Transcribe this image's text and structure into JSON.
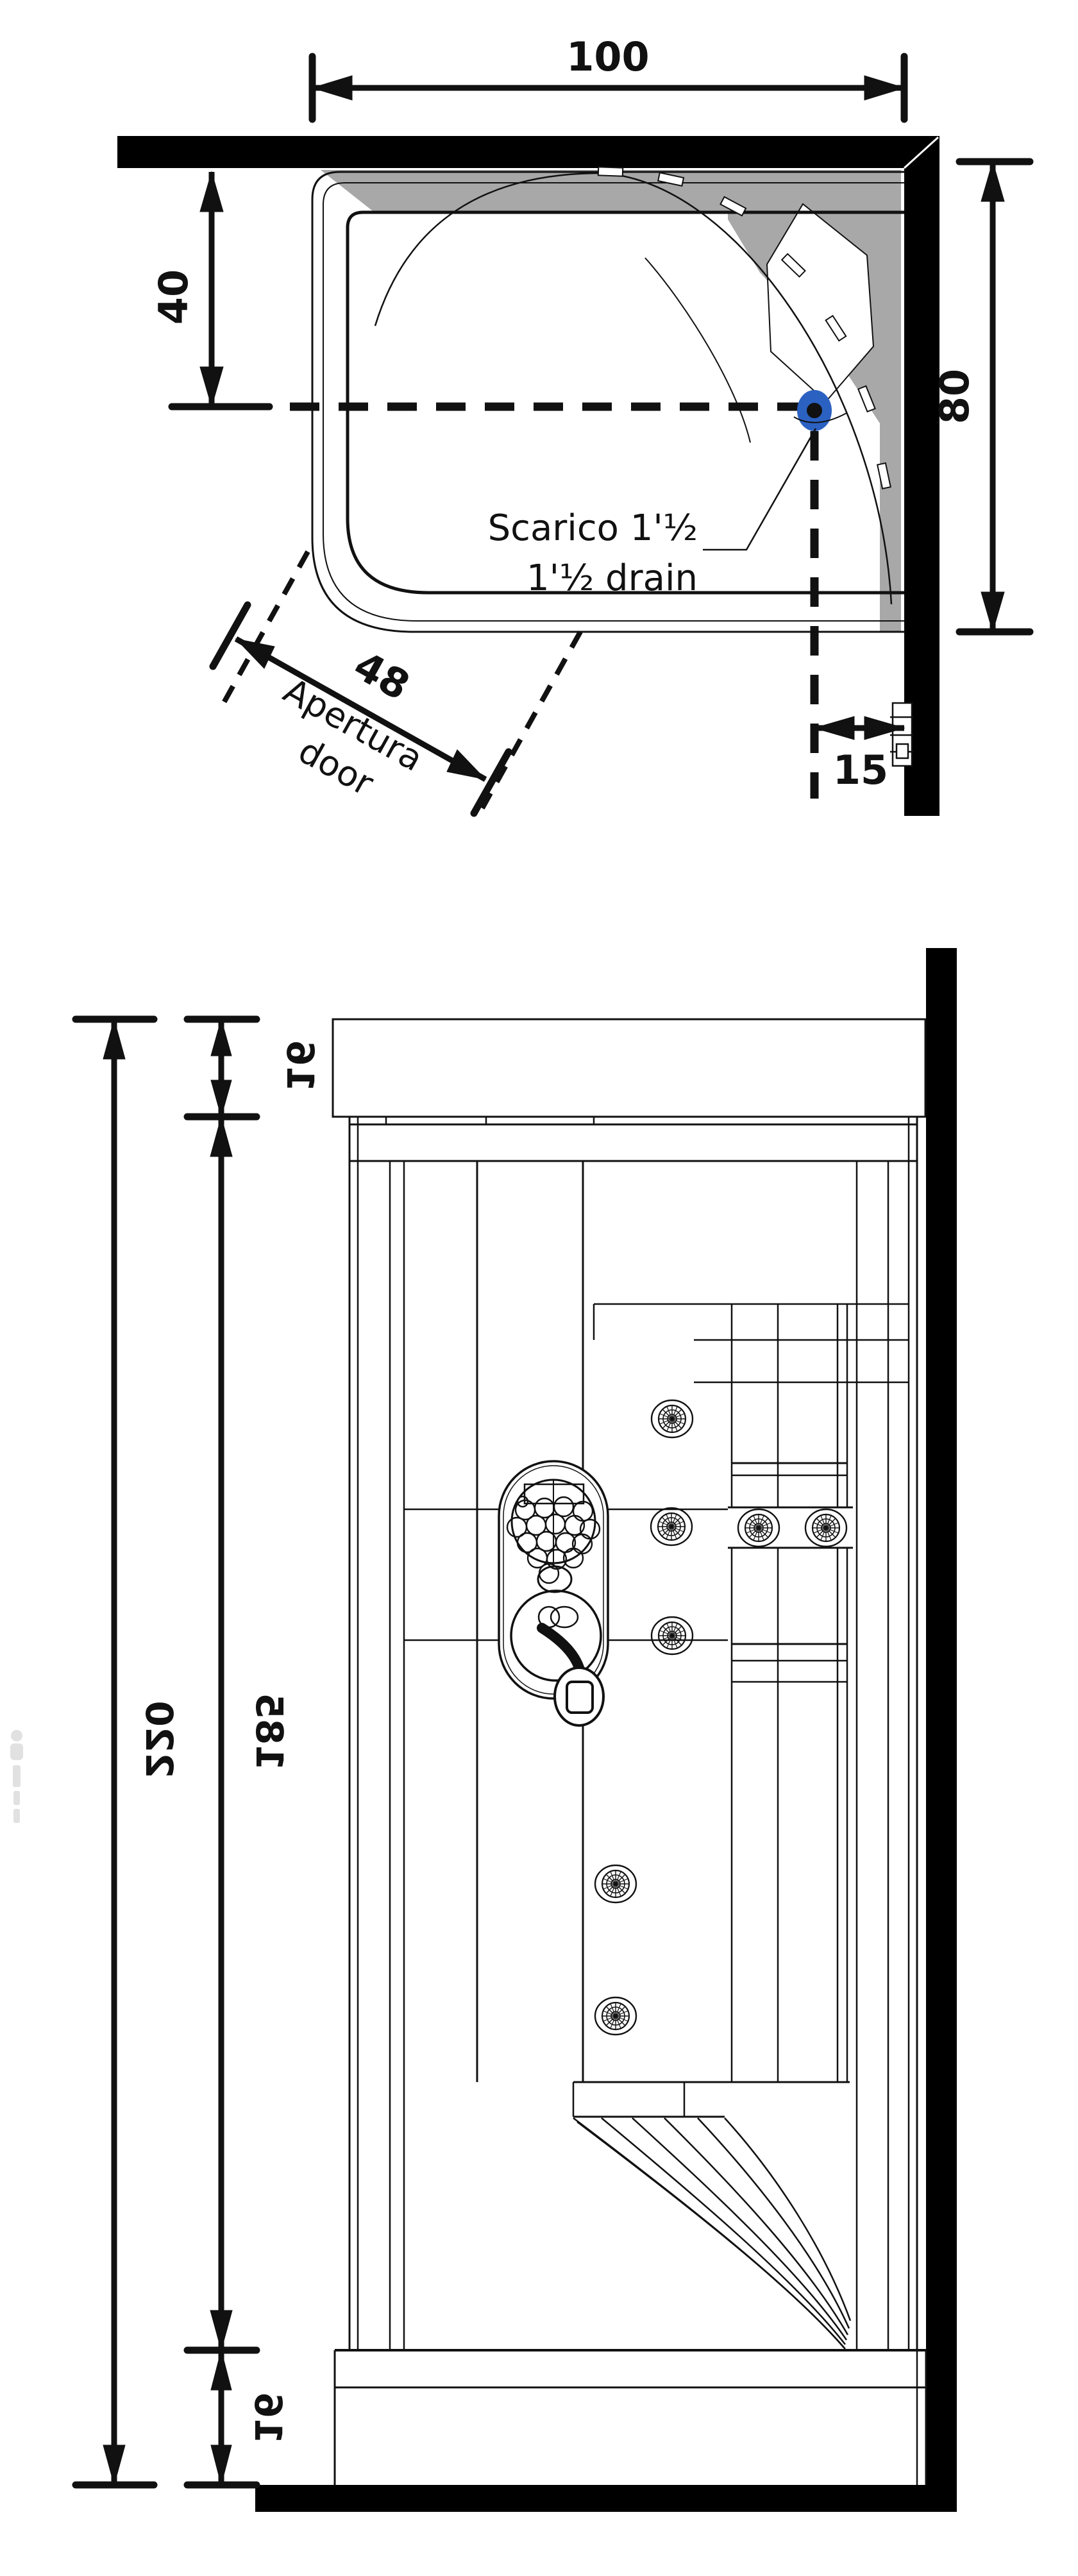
{
  "colors": {
    "line": "#111111",
    "wall_black": "#000000",
    "panel_gray": "#a8a8a8",
    "drain_blue": "#2b62c2"
  },
  "plan_view": {
    "width_label": "100",
    "drain_offset_label": "40",
    "depth_label": "80",
    "drain_wall_label": "15",
    "door_width_label": "48",
    "door_note_line1": "Apertura",
    "door_note_line2": "door",
    "drain_note_line1": "Scarico 1'½",
    "drain_note_line2": "1'½ drain"
  },
  "elevation_view": {
    "total_height_label": "220",
    "top_section_label": "16",
    "mid_section_label": "185",
    "bottom_section_label": "16"
  }
}
